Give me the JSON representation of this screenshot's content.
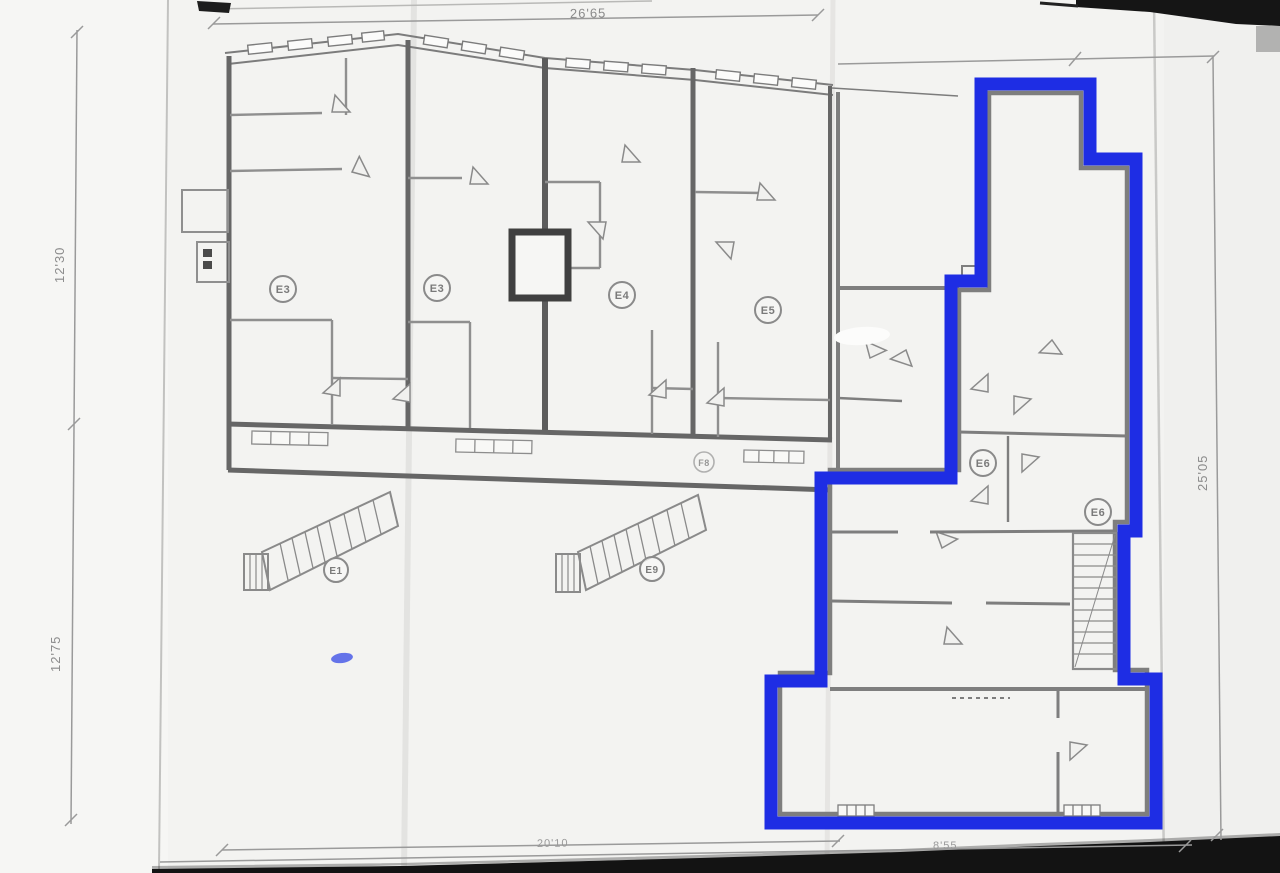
{
  "dims": {
    "top": "26'65",
    "left_upper": "12'30",
    "left_lower": "12'75",
    "right": "25'05",
    "bottom_left": "20'10",
    "bottom_right": "8'55"
  },
  "rooms": {
    "apt1": "E3",
    "apt2": "E3",
    "apt3": "E4",
    "apt4": "E5",
    "corridor": "F8",
    "unit_upper": "E6",
    "unit_stair": "E6",
    "stair_left": "E1",
    "stair_mid": "E9"
  },
  "highlight": {
    "color": "#1e2de4"
  }
}
